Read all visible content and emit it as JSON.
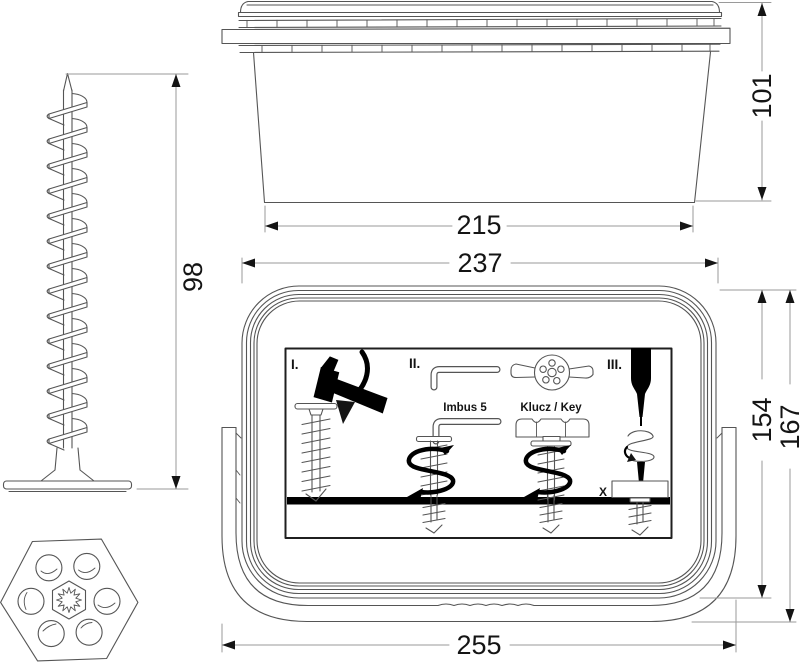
{
  "figure": {
    "type": "technical-drawing",
    "views": {
      "left": "spiral-anchor-screw-side-view",
      "top": "bucket-with-lid-side-view",
      "bottom_center": "bucket-front-view-with-instruction-label",
      "bottom_left": "hex-cap-top-view"
    }
  },
  "dimensions": {
    "screw_length": "98",
    "box_side_height": "101",
    "box_side_bottom_width": "215",
    "front_top_width": "237",
    "front_body_height": "154",
    "front_total_height": "167",
    "front_total_width": "255"
  },
  "instruction_label": {
    "step_1": "I.",
    "step_2": "II.",
    "step_3": "III.",
    "allen_key_size": "Imbus 5",
    "key_tool": "Klucz / Key",
    "depth_mark": "X"
  },
  "colors": {
    "background": "#ffffff",
    "line": "#555555",
    "dimension_line": "#9a9a9a",
    "text": "#141414",
    "solid": "#000000"
  }
}
